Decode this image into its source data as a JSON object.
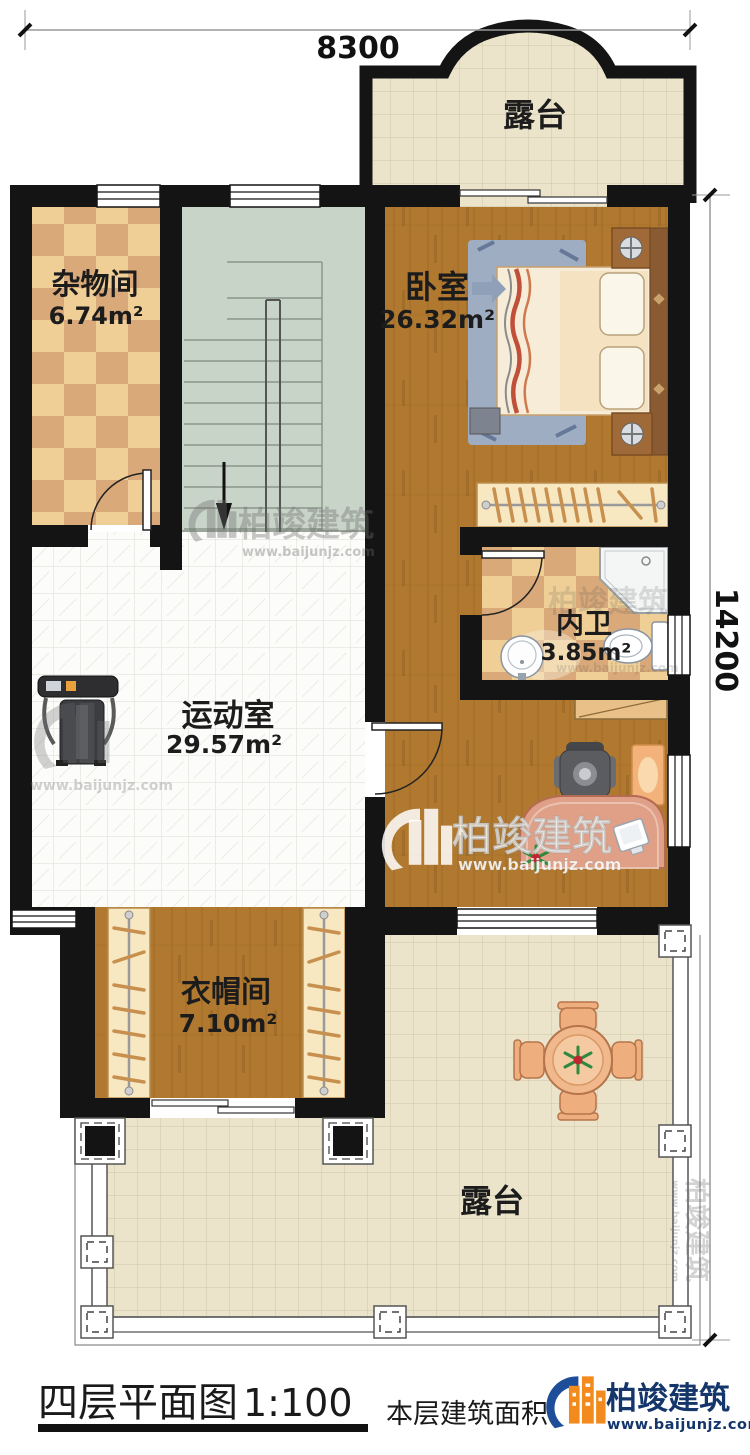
{
  "dimensions": {
    "width": "8300",
    "height": "14200"
  },
  "rooms": [
    {
      "id": "terrace-top",
      "name": "露台",
      "area": ""
    },
    {
      "id": "storage",
      "name": "杂物间",
      "area": "6.74m²"
    },
    {
      "id": "bedroom",
      "name": "卧室",
      "area": "26.32m²"
    },
    {
      "id": "bathroom",
      "name": "内卫",
      "area": "3.85m²"
    },
    {
      "id": "gym",
      "name": "运动室",
      "area": "29.57m²"
    },
    {
      "id": "cloakroom",
      "name": "衣帽间",
      "area": "7.10m²"
    },
    {
      "id": "terrace-bottom",
      "name": "露台",
      "area": ""
    }
  ],
  "title": {
    "main": "四层平面图",
    "scale": "1:100",
    "area_note": "本层建筑面积"
  },
  "brand": {
    "name": "柏竣建筑",
    "website": "www.baijunjz.com"
  },
  "watermark": {
    "name": "柏竣建筑",
    "website": "www.baijunjz.com"
  },
  "colors": {
    "wall": "#141414",
    "wood": "#b0792f",
    "checker_light": "#f0cf97",
    "checker_dark": "#d9a97a",
    "terrace_tile": "#ebe4cb",
    "stair": "#c9d4c9",
    "brand_blue": "#1e4e9a",
    "brand_orange": "#f28a1e",
    "desk_salmon": "#dfa087"
  }
}
